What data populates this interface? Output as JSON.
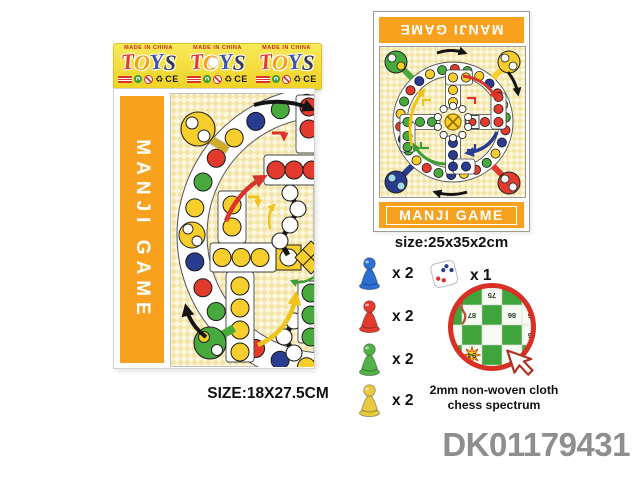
{
  "page": {
    "product_code": "DK01179431",
    "code_color": "#8E8E8E"
  },
  "header_strip": {
    "made_in": "MADE IN CHINA",
    "units": 3,
    "brand_letters": [
      {
        "ch": "T",
        "color": "#E23B2E"
      },
      {
        "ch": "O",
        "color": "#F59E1C"
      },
      {
        "ch": "Y",
        "color": "#3D53A5"
      },
      {
        "ch": "S",
        "color": "#3A3A55"
      }
    ],
    "cert": {
      "ce_label": "CE",
      "recycle_symbol": "♻"
    }
  },
  "left_package": {
    "band_label": "MANJI GAME",
    "band_color": "#F7A11E",
    "size_caption": "SIZE:18X27.5CM"
  },
  "right_panel": {
    "top_banner_label": "MANJI GAME",
    "bottom_banner_label": "MANJI GAME",
    "banner_color": "#F7A11E",
    "size_caption": "size:25x35x2cm"
  },
  "components": {
    "pawns": [
      {
        "name": "blue-pawn",
        "color": "#2A6FD2",
        "qty": "x 2"
      },
      {
        "name": "red-pawn",
        "color": "#E23B2E",
        "qty": "x 2"
      },
      {
        "name": "green-pawn",
        "color": "#52B147",
        "qty": "x 2"
      },
      {
        "name": "yellow-pawn",
        "color": "#E9C93F",
        "qty": "x 2"
      }
    ],
    "dice": {
      "qty": "x 1"
    }
  },
  "detail": {
    "caption_line1": "2mm non-woven cloth",
    "caption_line2": "chess spectrum",
    "ring_color": "#D93025",
    "cell_numbers": [
      "75",
      "8",
      "87",
      "86",
      "85",
      "96",
      "94",
      "95"
    ]
  },
  "board": {
    "palette": {
      "red": "#E23B2E",
      "yellow": "#F8CE2C",
      "green": "#48A93C",
      "navy": "#2A3C8F",
      "white": "#FFFFFF"
    },
    "left_ring_dots": [
      "yellow",
      "navy",
      "red",
      "yellow",
      "green",
      "red",
      "navy",
      "PIECE",
      "yellow",
      "green",
      "red",
      "yellow",
      "navy",
      "green",
      "yellow"
    ],
    "right_ring_dots": [
      "red",
      "green",
      "yellow",
      "navy",
      "red",
      "yellow",
      "green",
      "red",
      "navy",
      "yellow",
      "green",
      "red",
      "yellow",
      "navy",
      "green",
      "red",
      "yellow",
      "green",
      "navy",
      "red",
      "yellow",
      "green",
      "red",
      "navy",
      "yellow",
      "green"
    ],
    "arms": {
      "up": "yellow",
      "right": "red",
      "down": "navy",
      "left": "green"
    },
    "corners": {
      "top_left": "green",
      "top_right": "yellow",
      "bottom_left": "navy",
      "bottom_right": "red"
    }
  }
}
